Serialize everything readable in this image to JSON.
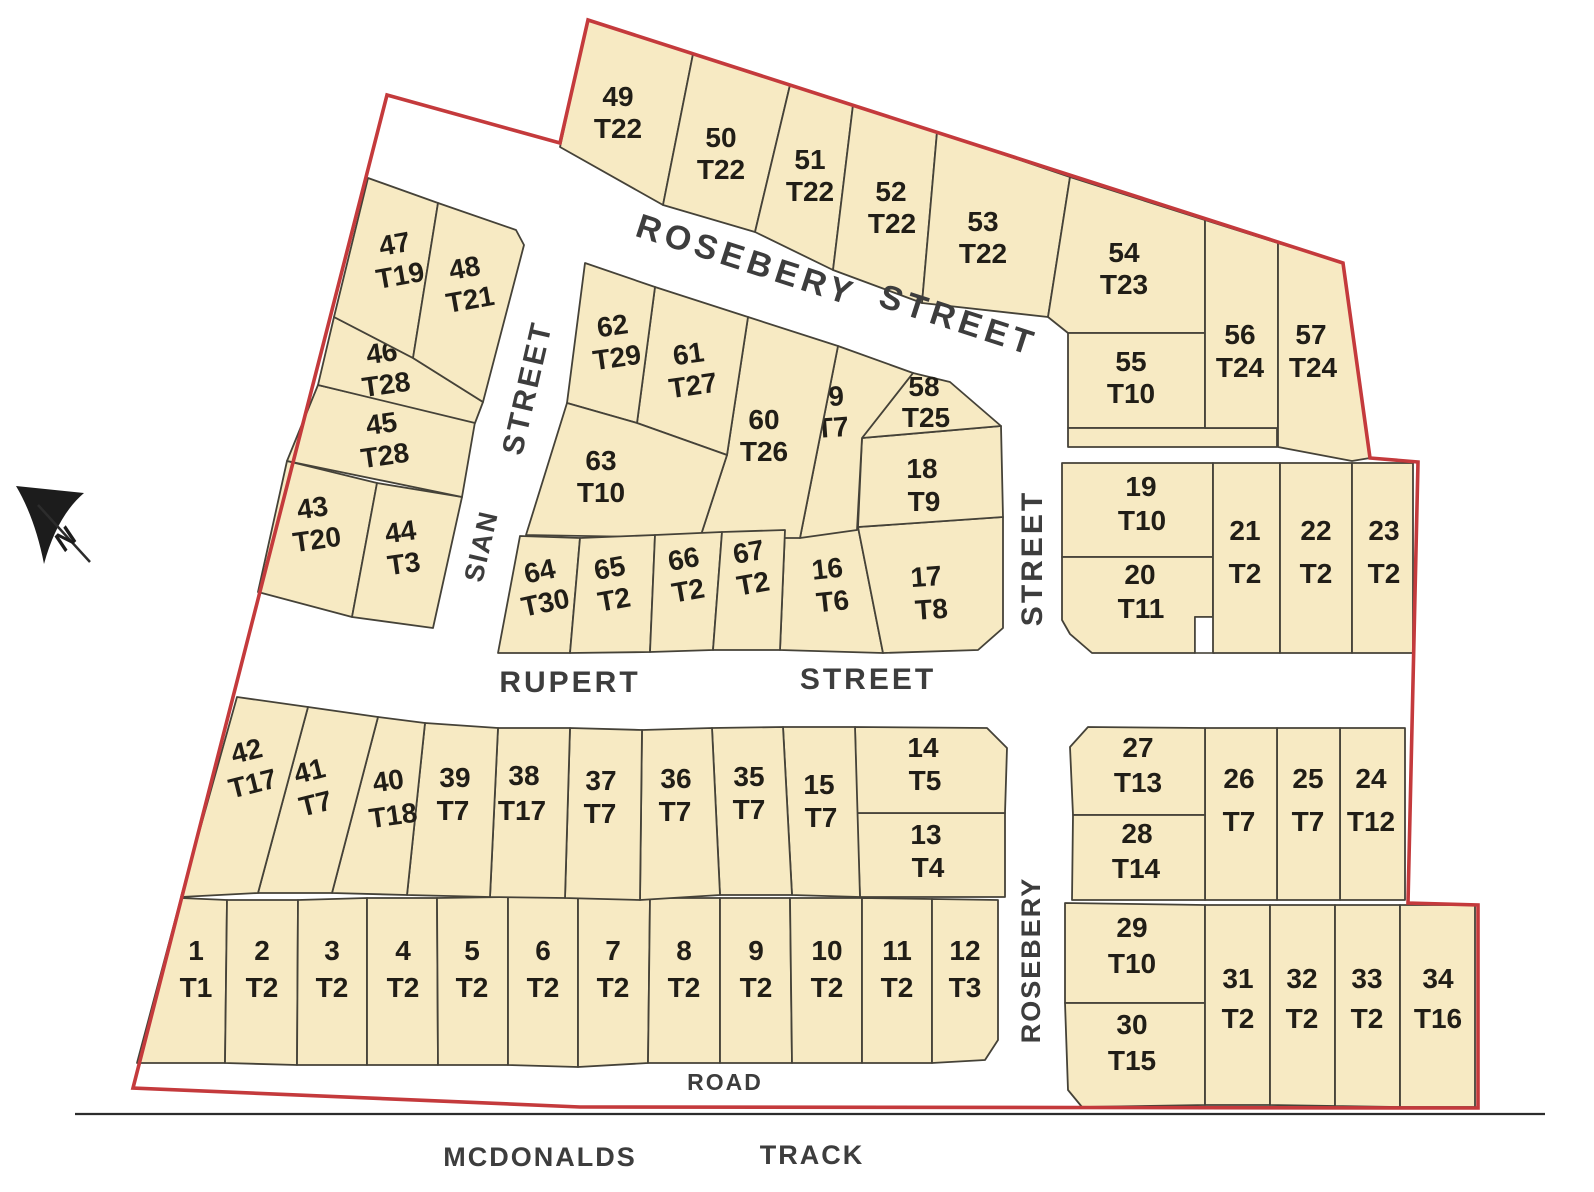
{
  "map": {
    "north_label": "N",
    "streets": {
      "rosebery_upper_1": "ROSEBERY",
      "rosebery_upper_2": "STREET",
      "street_vertical_upper": "STREET",
      "sian_1": "SIAN",
      "sian_2": "STREET",
      "rupert_1": "RUPERT",
      "rupert_2": "STREET",
      "rosebery_lower": "ROSEBERY",
      "road": "ROAD",
      "track_1": "MCDONALDS",
      "track_2": "TRACK"
    },
    "colors": {
      "lot_fill": "#f7eac3",
      "lot_stroke": "#454238",
      "boundary_red": "#c43a3c",
      "lot_label": "#211e17",
      "street_label": "#3d3d3d"
    },
    "lots": [
      {
        "n": "1",
        "t": "T1"
      },
      {
        "n": "2",
        "t": "T2"
      },
      {
        "n": "3",
        "t": "T2"
      },
      {
        "n": "4",
        "t": "T2"
      },
      {
        "n": "5",
        "t": "T2"
      },
      {
        "n": "6",
        "t": "T2"
      },
      {
        "n": "7",
        "t": "T2"
      },
      {
        "n": "8",
        "t": "T2"
      },
      {
        "n": "9",
        "t": "T2"
      },
      {
        "n": "10",
        "t": "T2"
      },
      {
        "n": "11",
        "t": "T2"
      },
      {
        "n": "12",
        "t": "T3"
      },
      {
        "n": "13",
        "t": "T4"
      },
      {
        "n": "14",
        "t": "T5"
      },
      {
        "n": "15",
        "t": "T7"
      },
      {
        "n": "16",
        "t": "T6"
      },
      {
        "n": "17",
        "t": "T8"
      },
      {
        "n": "18",
        "t": "T9"
      },
      {
        "n": "19",
        "t": "T10"
      },
      {
        "n": "20",
        "t": "T11"
      },
      {
        "n": "21",
        "t": "T2"
      },
      {
        "n": "22",
        "t": "T2"
      },
      {
        "n": "23",
        "t": "T2"
      },
      {
        "n": "24",
        "t": "T12"
      },
      {
        "n": "25",
        "t": "T7"
      },
      {
        "n": "26",
        "t": "T7"
      },
      {
        "n": "27",
        "t": "T13"
      },
      {
        "n": "28",
        "t": "T14"
      },
      {
        "n": "29",
        "t": "T10"
      },
      {
        "n": "30",
        "t": "T15"
      },
      {
        "n": "31",
        "t": "T2"
      },
      {
        "n": "32",
        "t": "T2"
      },
      {
        "n": "33",
        "t": "T2"
      },
      {
        "n": "34",
        "t": "T16"
      },
      {
        "n": "35",
        "t": "T7"
      },
      {
        "n": "36",
        "t": "T7"
      },
      {
        "n": "37",
        "t": "T7"
      },
      {
        "n": "38",
        "t": "T17"
      },
      {
        "n": "39",
        "t": "T7"
      },
      {
        "n": "40",
        "t": "T18"
      },
      {
        "n": "41",
        "t": "T7"
      },
      {
        "n": "42",
        "t": "T17"
      },
      {
        "n": "43",
        "t": "T20"
      },
      {
        "n": "44",
        "t": "T3"
      },
      {
        "n": "45",
        "t": "T28"
      },
      {
        "n": "46",
        "t": "T28"
      },
      {
        "n": "47",
        "t": "T19"
      },
      {
        "n": "48",
        "t": "T21"
      },
      {
        "n": "49",
        "t": "T22"
      },
      {
        "n": "50",
        "t": "T22"
      },
      {
        "n": "51",
        "t": "T22"
      },
      {
        "n": "52",
        "t": "T22"
      },
      {
        "n": "53",
        "t": "T22"
      },
      {
        "n": "54",
        "t": "T23"
      },
      {
        "n": "55",
        "t": "T10"
      },
      {
        "n": "56",
        "t": "T24"
      },
      {
        "n": "57",
        "t": "T24"
      },
      {
        "n": "58",
        "t": "T25"
      },
      {
        "n": "59",
        "t": "T7"
      },
      {
        "n": "60",
        "t": "T26"
      },
      {
        "n": "61",
        "t": "T27"
      },
      {
        "n": "62",
        "t": "T29"
      },
      {
        "n": "63",
        "t": "T10"
      },
      {
        "n": "64",
        "t": "T30"
      },
      {
        "n": "65",
        "t": "T2"
      },
      {
        "n": "66",
        "t": "T2"
      },
      {
        "n": "67",
        "t": "T2"
      }
    ]
  }
}
